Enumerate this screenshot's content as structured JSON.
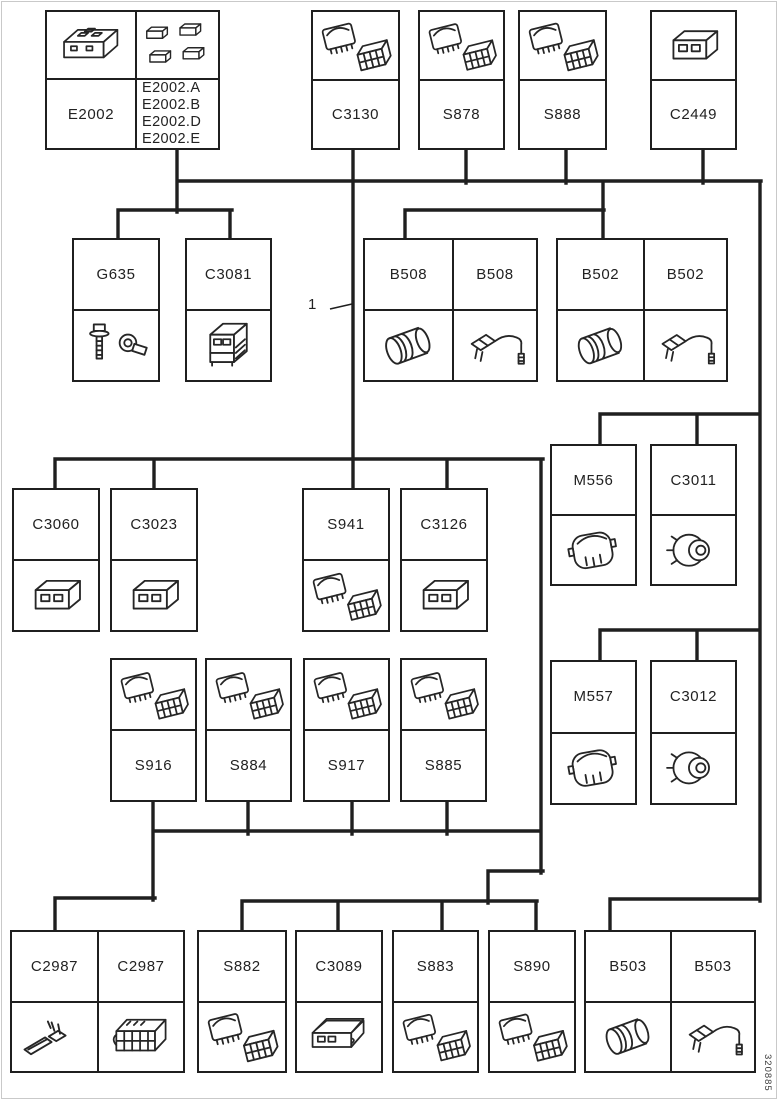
{
  "diagram": {
    "callout_label": "1",
    "footer_code": "320885",
    "colors": {
      "ink": "#1f1f1f",
      "background": "#ffffff"
    },
    "nodes": [
      {
        "key": "E2002",
        "type": "compound",
        "label": "E2002",
        "icon": "module-icon",
        "variants_icon": "mini-connectors-icon",
        "variants": [
          "E2002.A",
          "E2002.B",
          "E2002.D",
          "E2002.E"
        ]
      },
      {
        "key": "C3130",
        "label": "C3130",
        "icon": "switch-connector-icon"
      },
      {
        "key": "S878",
        "label": "S878",
        "icon": "switch-connector-icon"
      },
      {
        "key": "S888",
        "label": "S888",
        "icon": "switch-connector-icon"
      },
      {
        "key": "C2449",
        "label": "C2449",
        "icon": "connector-icon"
      },
      {
        "key": "G635",
        "label": "G635",
        "icon": "ground-terminal-icon"
      },
      {
        "key": "C3081",
        "label": "C3081",
        "icon": "relay-module-icon"
      },
      {
        "key": "B508-1",
        "label": "B508",
        "icon": "bulb-socket-icon"
      },
      {
        "key": "B508-2",
        "label": "B508",
        "icon": "bulb-holder-icon"
      },
      {
        "key": "B502-1",
        "label": "B502",
        "icon": "bulb-socket-icon"
      },
      {
        "key": "B502-2",
        "label": "B502",
        "icon": "bulb-holder-icon"
      },
      {
        "key": "M556",
        "label": "M556",
        "icon": "motor-connector-icon"
      },
      {
        "key": "C3011",
        "label": "C3011",
        "icon": "round-connector-icon"
      },
      {
        "key": "C3060",
        "label": "C3060",
        "icon": "connector-icon"
      },
      {
        "key": "C3023",
        "label": "C3023",
        "icon": "connector-icon"
      },
      {
        "key": "S941",
        "label": "S941",
        "icon": "switch-connector-icon"
      },
      {
        "key": "C3126",
        "label": "C3126",
        "icon": "connector-icon"
      },
      {
        "key": "S916",
        "label": "S916",
        "icon": "switch-connector-icon"
      },
      {
        "key": "S884",
        "label": "S884",
        "icon": "switch-connector-icon"
      },
      {
        "key": "S917",
        "label": "S917",
        "icon": "switch-connector-icon"
      },
      {
        "key": "S885",
        "label": "S885",
        "icon": "switch-connector-icon"
      },
      {
        "key": "M557",
        "label": "M557",
        "icon": "motor-connector-icon"
      },
      {
        "key": "C3012",
        "label": "C3012",
        "icon": "round-connector-icon"
      },
      {
        "key": "C2987-1",
        "label": "C2987",
        "icon": "terminal-pin-icon"
      },
      {
        "key": "C2987-2",
        "label": "C2987",
        "icon": "connector-block-icon"
      },
      {
        "key": "S882",
        "label": "S882",
        "icon": "switch-connector-icon"
      },
      {
        "key": "C3089",
        "label": "C3089",
        "icon": "covered-connector-icon"
      },
      {
        "key": "S883",
        "label": "S883",
        "icon": "switch-connector-icon"
      },
      {
        "key": "S890",
        "label": "S890",
        "icon": "switch-connector-icon"
      },
      {
        "key": "B503-1",
        "label": "B503",
        "icon": "bulb-socket-icon"
      },
      {
        "key": "B503-2",
        "label": "B503",
        "icon": "bulb-holder-icon"
      }
    ]
  }
}
